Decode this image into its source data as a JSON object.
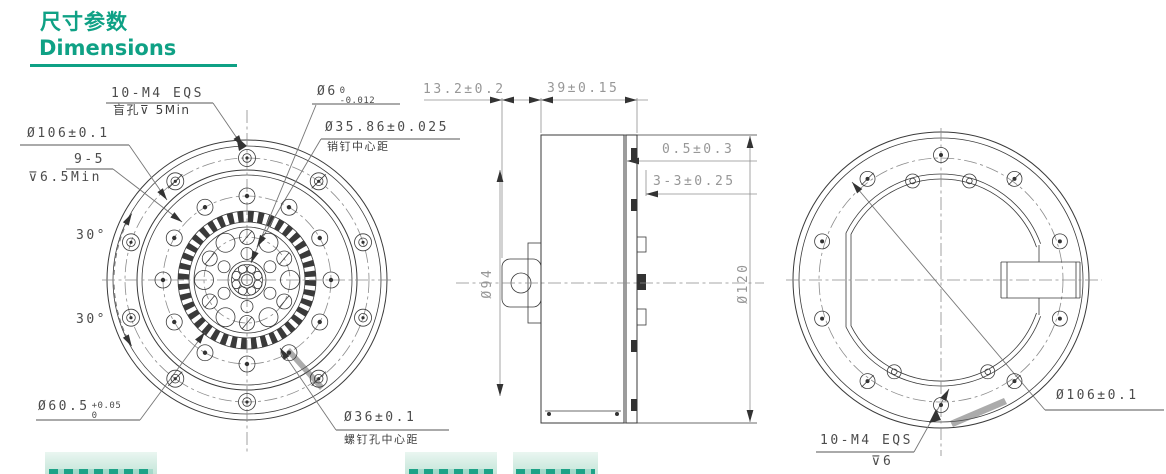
{
  "header": {
    "title_zh": "尺寸参数",
    "title_en": "Dimensions"
  },
  "colors": {
    "accent": "#0fa185",
    "drawing_line": "#3a3a3a",
    "dim_text_gray": "#979797",
    "label_text_dark": "#4c4c4c",
    "highlight_patch_bg": "#d3ece2",
    "highlight_patch_text": "#1ea287"
  },
  "front_view": {
    "bolt_spec": "10-M4 EQS",
    "bolt_spec_sub": "盲孔⊽ 5Min",
    "pin_hole_dia": "Ø6",
    "pin_hole_tol_upper": "0",
    "pin_hole_tol_lower": "-0.012",
    "flange_bolt_circle": "Ø106±0.1",
    "counterbore": "9-5",
    "counterbore_depth": "⊽6.5Min",
    "angle_top": "30°",
    "angle_bottom": "30°",
    "spigot_dia": "Ø60.5",
    "spigot_tol_upper": "+0.05",
    "spigot_tol_lower": "0",
    "pin_bolt_circle": "Ø35.86±0.025",
    "pin_bolt_circle_note": "销钉中心距",
    "screw_bolt_circle": "Ø36±0.1",
    "screw_bolt_circle_note": "螺钉孔中心距"
  },
  "side_view": {
    "front_depth": "13.2±0.2",
    "body_depth": "39±0.15",
    "gap": "0.5±0.3",
    "tab_width": "3-3±0.25",
    "body_dia": "Ø94",
    "flange_dia": "Ø120"
  },
  "rear_view": {
    "flange_bolt_circle": "Ø106±0.1",
    "bolt_spec": "10-M4 EQS",
    "bolt_depth": "⊽6"
  }
}
